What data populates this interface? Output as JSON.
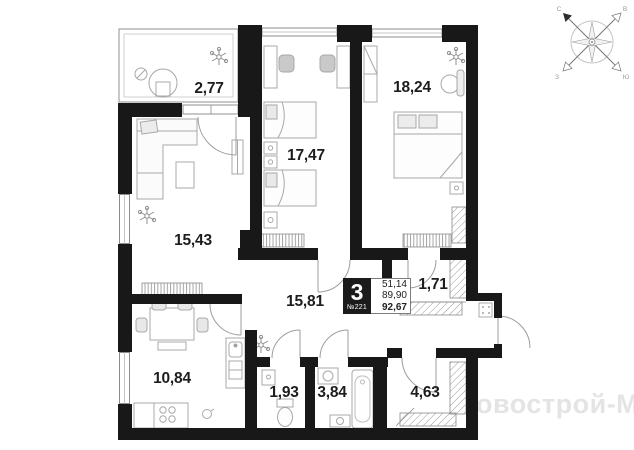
{
  "apartment_card": {
    "rooms_count": "3",
    "unit_number": "№221",
    "areas": [
      "51,14",
      "89,90",
      "92,67"
    ]
  },
  "room_areas": {
    "balcony": "2,77",
    "bedroom_children": "17,47",
    "bedroom_master": "18,24",
    "living_room": "15,43",
    "hallway": "15,81",
    "closet": "1,71",
    "kitchen": "10,84",
    "wc": "1,93",
    "bathroom": "3,84",
    "wardrobe": "4,63"
  },
  "compass": {
    "nw": "С",
    "ne": "В",
    "se": "Ю",
    "sw": "З"
  },
  "watermark": "овострой-М"
}
